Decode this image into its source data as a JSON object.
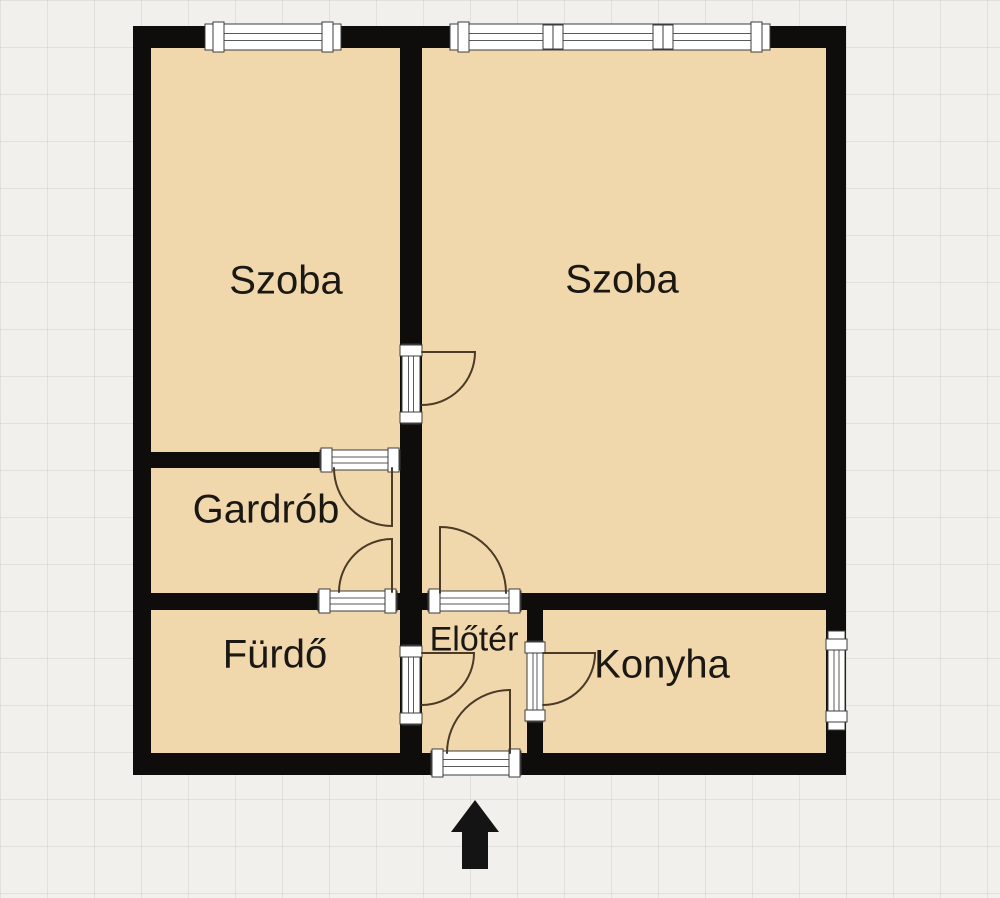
{
  "colors": {
    "background": "#f1f0ed",
    "floor": "#f0d8ac",
    "wall": "#0e0d0b",
    "frame_fill": "#ffffff",
    "frame_stroke": "#3c3c3c",
    "frame_line": "#5a5a5a",
    "door_arc": "#4a3a26",
    "label": "#1b1814",
    "arrow": "#141414"
  },
  "floorplan": {
    "footprint": {
      "x": 133,
      "y": 26,
      "w": 713,
      "h": 749
    },
    "rooms": [
      {
        "id": "szoba-left",
        "label": "Szoba",
        "cx": 286,
        "cy": 281,
        "font_px": 40
      },
      {
        "id": "szoba-right",
        "label": "Szoba",
        "cx": 622,
        "cy": 280,
        "font_px": 40
      },
      {
        "id": "gardrob",
        "label": "Gardrób",
        "cx": 266,
        "cy": 510,
        "font_px": 40
      },
      {
        "id": "furdo",
        "label": "Fürdő",
        "cx": 275,
        "cy": 655,
        "font_px": 40
      },
      {
        "id": "eloter",
        "label": "Előtér",
        "cx": 474,
        "cy": 640,
        "font_px": 34
      },
      {
        "id": "konyha",
        "label": "Konyha",
        "cx": 662,
        "cy": 665,
        "font_px": 40
      }
    ],
    "walls": [
      {
        "id": "top",
        "x": 133,
        "y": 26,
        "w": 713,
        "h": 22
      },
      {
        "id": "bottom",
        "x": 133,
        "y": 753,
        "w": 713,
        "h": 22
      },
      {
        "id": "left",
        "x": 133,
        "y": 26,
        "w": 18,
        "h": 749
      },
      {
        "id": "right",
        "x": 826,
        "y": 26,
        "w": 20,
        "h": 749
      },
      {
        "id": "center-vertical",
        "x": 400,
        "y": 48,
        "w": 22,
        "h": 706
      },
      {
        "id": "szoba-gardrob",
        "x": 151,
        "y": 452,
        "w": 249,
        "h": 16
      },
      {
        "id": "mid-horizontal",
        "x": 151,
        "y": 593,
        "w": 675,
        "h": 17
      },
      {
        "id": "eloter-konyha",
        "x": 527,
        "y": 610,
        "w": 16,
        "h": 144
      }
    ],
    "frames": [
      {
        "id": "window-szoba-left",
        "kind": "window",
        "x": 205,
        "y": 24,
        "w": 136,
        "h": 26,
        "dividers": []
      },
      {
        "id": "window-szoba-right",
        "kind": "window",
        "x": 450,
        "y": 24,
        "w": 320,
        "h": 26,
        "dividers": [
          543,
          553,
          653,
          663
        ]
      },
      {
        "id": "window-konyha",
        "kind": "window",
        "x": 828,
        "y": 631,
        "w": 17,
        "h": 99,
        "dividers": []
      },
      {
        "id": "door-frame-szoba-right",
        "kind": "door",
        "x": 402,
        "y": 344,
        "w": 18,
        "h": 80,
        "dividers": []
      },
      {
        "id": "door-frame-gardrob-felso",
        "kind": "door",
        "x": 320,
        "y": 450,
        "w": 80,
        "h": 20,
        "dividers": []
      },
      {
        "id": "door-frame-gardrob-also",
        "kind": "door",
        "x": 318,
        "y": 591,
        "w": 79,
        "h": 20,
        "dividers": []
      },
      {
        "id": "door-frame-eloter-szoba",
        "kind": "door",
        "x": 428,
        "y": 591,
        "w": 93,
        "h": 20,
        "dividers": []
      },
      {
        "id": "door-frame-furdo",
        "kind": "door",
        "x": 402,
        "y": 645,
        "w": 18,
        "h": 80,
        "dividers": []
      },
      {
        "id": "door-frame-konyha",
        "kind": "door",
        "x": 527,
        "y": 641,
        "w": 16,
        "h": 81,
        "dividers": []
      },
      {
        "id": "door-frame-bejarat",
        "kind": "door",
        "x": 431,
        "y": 751,
        "w": 90,
        "h": 24,
        "dividers": []
      }
    ],
    "door_swings": [
      {
        "id": "szoba-right",
        "path": "M422,352 L475,352 A53,53 0 0 1 422,405"
      },
      {
        "id": "gardrob-felso",
        "path": "M392,468 L392,526 A58,58 0 0 1 334,468"
      },
      {
        "id": "gardrob-also",
        "path": "M392,592 L392,539 A53,53 0 0 0 339,592"
      },
      {
        "id": "eloter-szoba",
        "path": "M440,593 L440,527 A66,66 0 0 1 506,593"
      },
      {
        "id": "furdo",
        "path": "M422,653 L474,653 A52,52 0 0 1 422,705"
      },
      {
        "id": "konyha",
        "path": "M543,653 L595,653 A52,52 0 0 1 543,705"
      },
      {
        "id": "bejarat",
        "path": "M510,753 L510,690 A63,63 0 0 0 447,753"
      }
    ],
    "entrance_arrow": {
      "path": "M475,800 L499,832 L488,832 L488,869 L462,869 L462,832 L451,832 Z"
    }
  }
}
